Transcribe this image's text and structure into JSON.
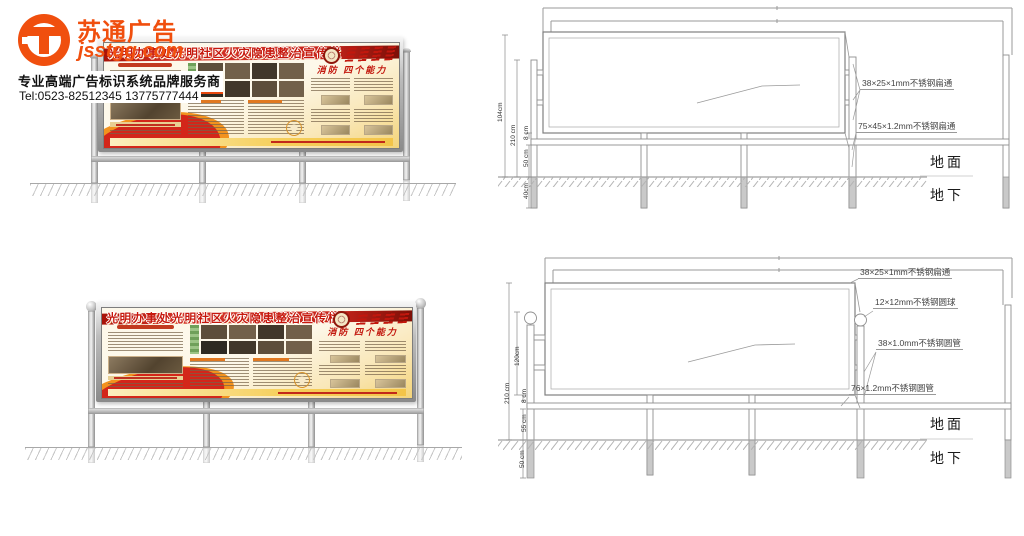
{
  "page": {
    "background": "#ffffff"
  },
  "logo": {
    "brand": "苏通广告",
    "domain": "jsstgg.com",
    "tagline": "专业高端广告标识系统品牌服务商",
    "tel": "Tel:0523-82512345  13775777444",
    "accent_color": "#f04f0e"
  },
  "board": {
    "title": "光明办事处光明社区火灾隐患整治宣传栏",
    "fire_section_title": "消防 四个能力",
    "header_red": "#c31f14",
    "panel_cream": "#fdf6e4",
    "strip_yellow": "#f5c94e"
  },
  "drawing_top": {
    "dim_labels": [
      "104cm",
      "210 cm",
      "8 cm",
      "50 cm",
      "40cm"
    ],
    "callouts": [
      "38×25×1mm不锈钢扁通",
      "75×45×1.2mm不锈钢扁通"
    ],
    "ground_label": "地面",
    "underground_label": "地下"
  },
  "drawing_bottom": {
    "dim_labels": [
      "120cm",
      "210 cm",
      "8 cm",
      "55 cm",
      "50 cm"
    ],
    "callouts": [
      "38×25×1mm不锈钢扁通",
      "12×12mm不锈钢圆球",
      "38×1.0mm不锈钢圆管",
      "76×1.2mm不锈钢圆管"
    ],
    "ground_label": "地面",
    "underground_label": "地下"
  }
}
